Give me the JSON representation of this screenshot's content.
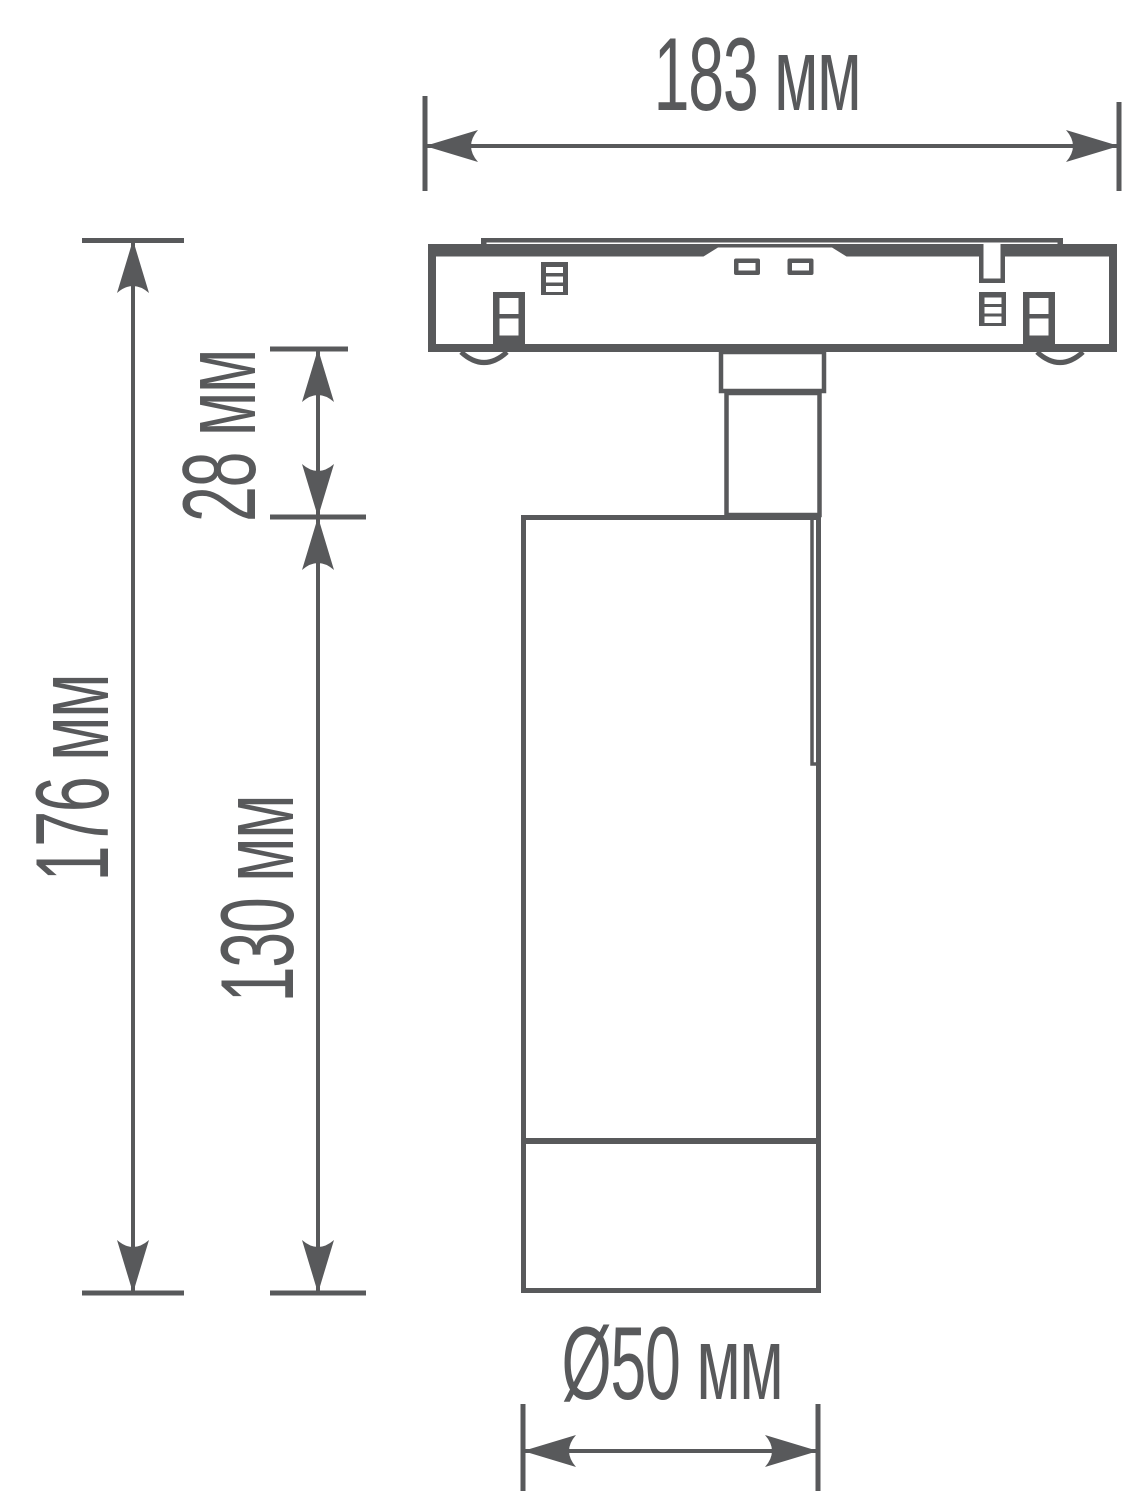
{
  "colors": {
    "line": "#58595b",
    "background": "#ffffff"
  },
  "dimensions": {
    "track_width": {
      "value": "183",
      "unit": "мм",
      "label": "183 мм"
    },
    "total_height": {
      "value": "176",
      "unit": "мм",
      "label": "176 мм"
    },
    "stem_height": {
      "value": "28",
      "unit": "мм",
      "label": "28 мм"
    },
    "body_height": {
      "value": "130",
      "unit": "мм",
      "label": "130 мм"
    },
    "body_diameter": {
      "value": "Ø50",
      "unit": "мм",
      "label": "Ø50 мм"
    }
  }
}
